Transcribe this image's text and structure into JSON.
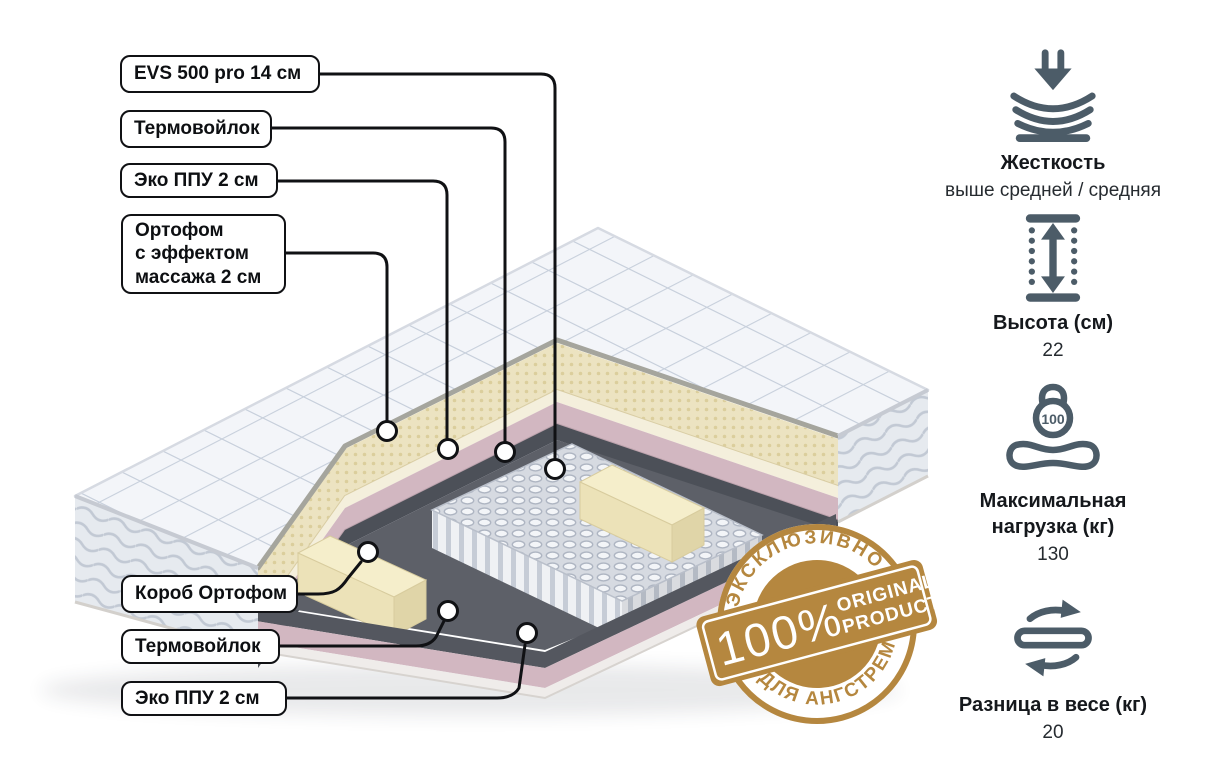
{
  "product": {
    "type": "mattress-cutaway-diagram"
  },
  "callouts": {
    "top": [
      {
        "label": "EVS 500 pro 14 см"
      },
      {
        "label": "Термовойлок"
      },
      {
        "label": "Эко ППУ 2 см"
      },
      {
        "lines": [
          "Ортофом",
          "с эффектом",
          "массажа 2 см"
        ]
      }
    ],
    "bottom": [
      {
        "label": "Короб Ортофом"
      },
      {
        "label": "Термовойлок"
      },
      {
        "label": "Эко ППУ 2 см"
      }
    ]
  },
  "specs": {
    "firmness": {
      "title": "Жесткость",
      "value": "выше средней / средняя"
    },
    "height": {
      "title": "Высота (см)",
      "value": "22"
    },
    "max_load": {
      "title_line1": "Максимальная",
      "title_line2": "нагрузка (кг)",
      "value": "130",
      "icon_label": "100"
    },
    "weight_diff": {
      "title": "Разница в весе (кг)",
      "value": "20"
    }
  },
  "badge": {
    "percent": "100%",
    "word1": "ORIGINAL",
    "word2": "PRODUCT",
    "arc_top": "ЭКСКЛЮЗИВНО",
    "arc_bottom": "ДЛЯ АНГСТРЕМ"
  },
  "colors": {
    "accent_gold": "#b5873f",
    "icon_slate": "#4c5c68",
    "callout_line": "#101114",
    "layer_pink": "#d2b7c1",
    "layer_cream": "#ece3c1",
    "layer_dark": "#54575f"
  }
}
